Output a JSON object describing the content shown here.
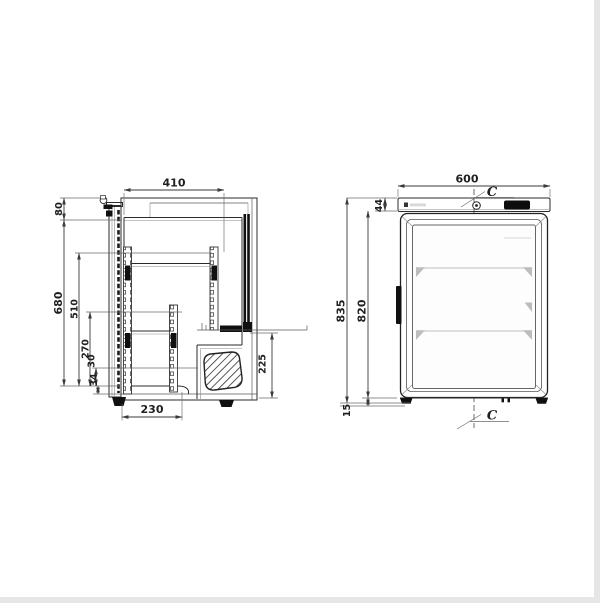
{
  "drawing": {
    "kind": "technical-dimension-drawing",
    "subject": "undercounter glass-door refrigerator, two orthographic views",
    "ink_color": "#2b2b2b",
    "dim_text_color": "#1f1f1f",
    "page_border_color": "#e6e6e6",
    "shelf_line_color": "#cccccc"
  },
  "side_view": {
    "name": "side section view",
    "dims": {
      "d410": "410",
      "d80": "80",
      "d680": "680",
      "d510": "510",
      "d270": "270",
      "d30": "30",
      "d34": "34",
      "d230": "230",
      "d225": "225"
    }
  },
  "front_view": {
    "name": "front view",
    "dims": {
      "d600": "600",
      "d44": "44",
      "d835": "835",
      "d820": "820",
      "d15": "15"
    },
    "centerline_label_top": "C",
    "centerline_label_bottom": "C"
  }
}
